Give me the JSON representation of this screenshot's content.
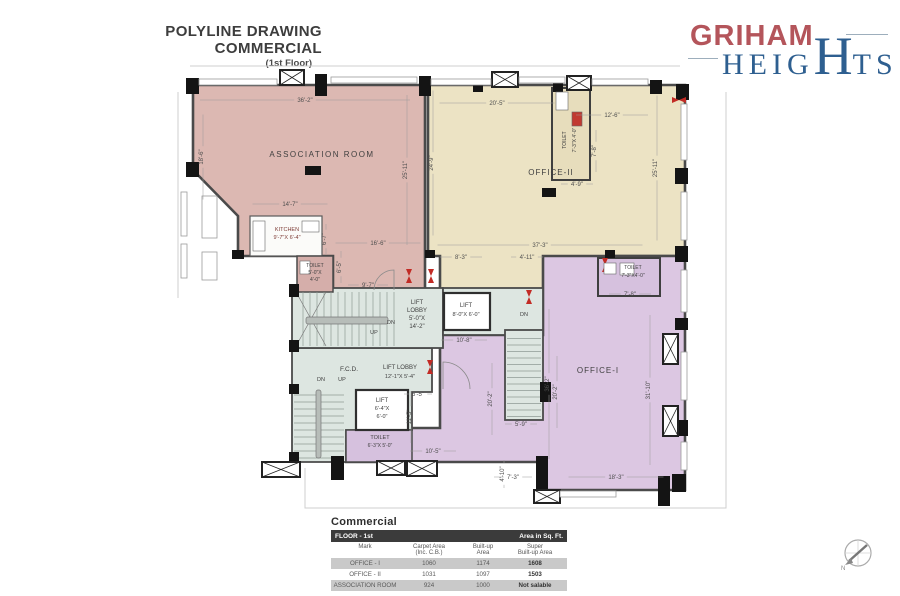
{
  "title": {
    "line1": "POLYLINE DRAWING",
    "line2": "COMMERCIAL",
    "line3": "(1st Floor)"
  },
  "logo": {
    "brand": "GRIHAM",
    "heights_pre": "HEIG",
    "heights_big": "H",
    "heights_post": "TS",
    "brand_color": "#b4555b",
    "heights_color": "#2e5f90"
  },
  "compass": {
    "label": "N",
    "cx": 858,
    "cy": 553,
    "r": 13
  },
  "table": {
    "title": "Commercial",
    "header_left": "FLOOR -  1st",
    "header_right": "Area in Sq. Ft.",
    "columns": [
      [
        "Mark"
      ],
      [
        "Carpet Area",
        "(Inc. C.B.)"
      ],
      [
        "Built-up",
        "Area"
      ],
      [
        "Super",
        "Built-up Area"
      ]
    ],
    "rows": [
      [
        "OFFICE - I",
        "1060",
        "1174",
        "1608"
      ],
      [
        "OFFICE - II",
        "1031",
        "1097",
        "1503"
      ],
      [
        "ASSOCIATION ROOM",
        "924",
        "1000",
        "Not salable"
      ]
    ]
  },
  "plan": {
    "colors": {
      "association": "#dcb8b2",
      "office2": "#ece3c4",
      "office1": "#dcc7e2",
      "hall": "#dde6e1",
      "wall": "#4a4a4a",
      "door": "#c22b25"
    },
    "site_lines": [
      "M 726,92 L 726,508 L 305,508 L 305,468",
      "M 190,66 L 680,66",
      "M 178,92 L 178,298"
    ],
    "regions": [
      {
        "n": "room-association",
        "pts": "193,85 425,85 425,292 333,292 333,256 238,256 238,216 193,170",
        "f": "#dcb8b2",
        "sw": 2.6
      },
      {
        "n": "room-office-2",
        "pts": "428,85 685,85 685,256 610,256 610,292 440,292 440,256 428,256",
        "f": "#ece3c4",
        "sw": 2.6
      },
      {
        "n": "room-office-1",
        "pts": "543,256 685,256 685,490 543,490 543,462 346,462 346,428 440,428 440,335 543,335",
        "f": "#dcc7e2",
        "sw": 2.6
      },
      {
        "n": "hall-lower",
        "pts": "292,348 432,348 432,392 412,392 412,430 346,430 346,462 292,462",
        "f": "#dde6e1",
        "sw": 1.8
      }
    ],
    "rects": [
      {
        "n": "hall-upper",
        "x": 292,
        "y": 288,
        "w": 151,
        "h": 60,
        "f": "#dde6e1",
        "s": "#4a4a4a",
        "sw": 1.8
      },
      {
        "n": "hall-lift-landing",
        "x": 443,
        "y": 288,
        "w": 100,
        "h": 47,
        "f": "#dde6e1",
        "s": "#4a4a4a",
        "sw": 1.8
      },
      {
        "n": "stair-well-right",
        "x": 505,
        "y": 330,
        "w": 38,
        "h": 90,
        "f": "#dde6e1",
        "s": "#4a4a4a",
        "sw": 1.8
      },
      {
        "n": "kitchen-room",
        "x": 250,
        "y": 216,
        "w": 72,
        "h": 40,
        "f": "#fbfbf9",
        "s": "#5a5a5a",
        "sw": 1.2
      },
      {
        "n": "toilet-association",
        "x": 297,
        "y": 256,
        "w": 36,
        "h": 36,
        "f": "#d5aeaa",
        "s": "#4a4a4a",
        "sw": 1.5
      },
      {
        "n": "toilet-office-2",
        "x": 552,
        "y": 88,
        "w": 38,
        "h": 92,
        "f": "#e7ddbc",
        "s": "#3f3f3f",
        "sw": 2
      },
      {
        "n": "toilet-office-1",
        "x": 598,
        "y": 258,
        "w": 62,
        "h": 38,
        "f": "#d6c1de",
        "s": "#3f3f3f",
        "sw": 2
      },
      {
        "n": "toilet-hall",
        "x": 346,
        "y": 430,
        "w": 66,
        "h": 32,
        "f": "#d6c1de",
        "s": "#4a4a4a",
        "sw": 1.5
      },
      {
        "n": "lift-1",
        "x": 444,
        "y": 293,
        "w": 46,
        "h": 37,
        "f": "#ffffff",
        "s": "#2f2f2f",
        "sw": 2.2
      },
      {
        "n": "lift-2",
        "x": 356,
        "y": 390,
        "w": 52,
        "h": 40,
        "f": "#ffffff",
        "s": "#2f2f2f",
        "sw": 2.2
      }
    ],
    "stairs": [
      {
        "x": 296,
        "y": 292,
        "w": 100,
        "h": 54,
        "o": "v",
        "step": 7,
        "rail": [
          306,
          317,
          82,
          7
        ],
        "cross": true
      },
      {
        "x": 294,
        "y": 388,
        "w": 50,
        "h": 72,
        "o": "h",
        "step": 7,
        "rail": [
          316,
          390,
          5,
          68
        ]
      },
      {
        "x": 507,
        "y": 332,
        "w": 34,
        "h": 86,
        "o": "h",
        "step": 6.5
      }
    ],
    "cols": [
      [
        186,
        78,
        13,
        16
      ],
      [
        315,
        74,
        12,
        22
      ],
      [
        419,
        76,
        12,
        20
      ],
      [
        473,
        80,
        10,
        12
      ],
      [
        553,
        80,
        10,
        12
      ],
      [
        650,
        80,
        12,
        14
      ],
      [
        676,
        84,
        13,
        16
      ],
      [
        186,
        162,
        13,
        15
      ],
      [
        232,
        250,
        12,
        9
      ],
      [
        289,
        284,
        10,
        13
      ],
      [
        289,
        340,
        10,
        12
      ],
      [
        289,
        384,
        10,
        10
      ],
      [
        289,
        452,
        10,
        10
      ],
      [
        675,
        168,
        13,
        16
      ],
      [
        675,
        246,
        13,
        16
      ],
      [
        675,
        318,
        13,
        12
      ],
      [
        675,
        420,
        13,
        16
      ],
      [
        672,
        474,
        14,
        18
      ],
      [
        305,
        166,
        16,
        9
      ],
      [
        542,
        188,
        14,
        9
      ],
      [
        540,
        382,
        11,
        20
      ],
      [
        331,
        456,
        13,
        24
      ],
      [
        536,
        456,
        12,
        36
      ],
      [
        658,
        476,
        12,
        30
      ],
      [
        425,
        250,
        10,
        8
      ],
      [
        605,
        250,
        10,
        8
      ]
    ],
    "xboxes": [
      [
        280,
        70,
        24,
        15
      ],
      [
        492,
        72,
        26,
        15
      ],
      [
        567,
        76,
        24,
        14
      ],
      [
        663,
        334,
        15,
        30
      ],
      [
        663,
        406,
        15,
        30
      ],
      [
        262,
        462,
        38,
        15
      ],
      [
        377,
        461,
        28,
        14
      ],
      [
        407,
        461,
        30,
        15
      ],
      [
        534,
        490,
        26,
        13
      ]
    ],
    "wins": [
      [
        199,
        79,
        78,
        6
      ],
      [
        331,
        77,
        86,
        6
      ],
      [
        431,
        79,
        60,
        6
      ],
      [
        519,
        77,
        46,
        6
      ],
      [
        592,
        79,
        56,
        6
      ],
      [
        181,
        192,
        6,
        44
      ],
      [
        181,
        244,
        6,
        34
      ],
      [
        202,
        196,
        15,
        42
      ],
      [
        202,
        252,
        15,
        28
      ],
      [
        681,
        104,
        6,
        56
      ],
      [
        681,
        192,
        6,
        48
      ],
      [
        681,
        270,
        6,
        42
      ],
      [
        681,
        352,
        6,
        48
      ],
      [
        681,
        442,
        6,
        28
      ],
      [
        560,
        491,
        56,
        6
      ]
    ],
    "arcs": [
      "M 443,389 L 443,362 A 27 27 0 0 1 470,389",
      "M 394,290 L 394,270 A 20 20 0 0 0 374,290"
    ],
    "doors": [
      [
        409,
        276,
        "v"
      ],
      [
        431,
        276,
        "v"
      ],
      [
        529,
        297,
        "v"
      ],
      [
        430,
        367,
        "v"
      ],
      [
        605,
        265,
        "v"
      ],
      [
        679,
        100,
        "h"
      ]
    ],
    "fixtures": [
      [
        572,
        112,
        10,
        14,
        "#c13a31"
      ],
      [
        556,
        92,
        12,
        18,
        "#ffffff"
      ],
      [
        604,
        263,
        12,
        11,
        "#ffffff"
      ],
      [
        620,
        263,
        14,
        12,
        "#ffffff"
      ],
      [
        300,
        261,
        10,
        13,
        "#ffffff"
      ],
      [
        253,
        221,
        12,
        30,
        "#ffffff"
      ],
      [
        302,
        221,
        17,
        11,
        "#ffffff"
      ]
    ],
    "dims": [
      {
        "t": "36'-2\"",
        "x": 305,
        "y": 102,
        "r": 0,
        "len": 210
      },
      {
        "t": "18'-6\"",
        "x": 203,
        "y": 157,
        "r": 90,
        "len": 85
      },
      {
        "t": "25'-11\"",
        "x": 407,
        "y": 170,
        "r": 90,
        "len": 150
      },
      {
        "t": "14'-7\"",
        "x": 290,
        "y": 206,
        "r": 0,
        "len": 75
      },
      {
        "t": "16'-6\"",
        "x": 378,
        "y": 245,
        "r": 0,
        "len": 85
      },
      {
        "t": "9'-7\"",
        "x": 368,
        "y": 287,
        "r": 0,
        "len": 40
      },
      {
        "t": "6'-5\"",
        "x": 341,
        "y": 267,
        "r": 90,
        "len": 32
      },
      {
        "t": "6'-7\"",
        "x": 326,
        "y": 239,
        "r": 90,
        "len": 30
      },
      {
        "t": "20'-5\"",
        "x": 497,
        "y": 105,
        "r": 0,
        "len": 115
      },
      {
        "t": "12'-6\"",
        "x": 612,
        "y": 117,
        "r": 0,
        "len": 72
      },
      {
        "t": "7'-8\"",
        "x": 596,
        "y": 151,
        "r": 90,
        "len": 42
      },
      {
        "t": "4'-9\"",
        "x": 577,
        "y": 186,
        "r": 0,
        "len": 32
      },
      {
        "t": "24'-9\"",
        "x": 433,
        "y": 163,
        "r": 90,
        "len": 145
      },
      {
        "t": "25'-11\"",
        "x": 657,
        "y": 168,
        "r": 90,
        "len": 145
      },
      {
        "t": "37'-3\"",
        "x": 540,
        "y": 247,
        "r": 0,
        "len": 205
      },
      {
        "t": "8'-3\"",
        "x": 461,
        "y": 259,
        "r": 0,
        "len": 42
      },
      {
        "t": "4'-11\"",
        "x": 527,
        "y": 259,
        "r": 0,
        "len": 32
      },
      {
        "t": "7'-8\"",
        "x": 630,
        "y": 296,
        "r": 0,
        "len": 42
      },
      {
        "t": "10'-8\"",
        "x": 464,
        "y": 342,
        "r": 0,
        "len": 46
      },
      {
        "t": "5'-5\"",
        "x": 418,
        "y": 396,
        "r": 0,
        "len": 28
      },
      {
        "t": "11'-5\"",
        "x": 411,
        "y": 417,
        "r": 90,
        "len": 52
      },
      {
        "t": "10'-5\"",
        "x": 433,
        "y": 453,
        "r": 0,
        "len": 46
      },
      {
        "t": "5'-9\"",
        "x": 521,
        "y": 426,
        "r": 0,
        "len": 32
      },
      {
        "t": "20'-2\"",
        "x": 492,
        "y": 399,
        "r": 90,
        "len": 72
      },
      {
        "t": "20'-2\"",
        "x": 557,
        "y": 392,
        "r": 90,
        "len": 72
      },
      {
        "t": "36'-2\"",
        "x": 549,
        "y": 384,
        "r": 90,
        "len": 150
      },
      {
        "t": "31'-10\"",
        "x": 650,
        "y": 390,
        "r": 90,
        "len": 150
      },
      {
        "t": "4'-10\"",
        "x": 504,
        "y": 474,
        "r": 90,
        "len": 28
      },
      {
        "t": "7'-3\"",
        "x": 513,
        "y": 479,
        "r": 0,
        "len": 38
      },
      {
        "t": "18'-3\"",
        "x": 616,
        "y": 479,
        "r": 0,
        "len": 95
      }
    ],
    "labels": [
      {
        "n": "room-label-association",
        "t": "ASSOCIATION ROOM",
        "x": 322,
        "y": 157,
        "s": 8,
        "ls": 1.5
      },
      {
        "n": "room-label-office-2",
        "t": "OFFICE-II",
        "x": 551,
        "y": 175,
        "s": 8,
        "ls": 1
      },
      {
        "n": "room-label-office-1",
        "t": "OFFICE-I",
        "x": 598,
        "y": 373,
        "s": 8,
        "ls": 1
      },
      {
        "n": "kitchen-label",
        "t": "KITCHEN",
        "x": 287,
        "y": 231,
        "s": 5.5,
        "c": "#7d3b35"
      },
      {
        "n": "kitchen-size-label",
        "t": "9'-7\"X 6'-4\"",
        "x": 287,
        "y": 239,
        "s": 5.5,
        "c": "#7d3b35"
      },
      {
        "n": "toilet-label",
        "t": "TOILET",
        "x": 315,
        "y": 267,
        "s": 5
      },
      {
        "n": "toilet-size-label",
        "t": "5'-0\"X",
        "x": 315,
        "y": 274,
        "s": 5
      },
      {
        "n": "toilet-size-label",
        "t": "4'-0\"",
        "x": 315,
        "y": 281,
        "s": 5
      },
      {
        "n": "toilet-label",
        "t": "TOILET",
        "x": 566,
        "y": 140,
        "s": 5,
        "r": -90
      },
      {
        "n": "toilet-size-label",
        "t": "7'-3\"X 4'-0\"",
        "x": 576,
        "y": 140,
        "s": 5,
        "r": -90
      },
      {
        "n": "toilet-label",
        "t": "TOILET",
        "x": 633,
        "y": 269,
        "s": 5
      },
      {
        "n": "toilet-size-label",
        "t": "7'-3\"X4'-0\"",
        "x": 633,
        "y": 277,
        "s": 5
      },
      {
        "n": "toilet-label",
        "t": "TOILET",
        "x": 380,
        "y": 439,
        "s": 5.5
      },
      {
        "n": "toilet-size-label",
        "t": "6'-3\"X 5'-0\"",
        "x": 380,
        "y": 447,
        "s": 5
      },
      {
        "n": "lift-lobby-label",
        "t": "LIFT",
        "x": 417,
        "y": 304,
        "s": 6
      },
      {
        "n": "lift-lobby-label",
        "t": "LOBBY",
        "x": 417,
        "y": 312,
        "s": 6
      },
      {
        "n": "lift-lobby-label",
        "t": "5'-0\"X",
        "x": 417,
        "y": 320,
        "s": 6
      },
      {
        "n": "lift-lobby-label",
        "t": "14'-2\"",
        "x": 417,
        "y": 328,
        "s": 6
      },
      {
        "n": "lift-label",
        "t": "LIFT",
        "x": 466,
        "y": 307,
        "s": 6
      },
      {
        "n": "lift-size-label",
        "t": "8'-0\"X 6'-0\"",
        "x": 466,
        "y": 316,
        "s": 5.5
      },
      {
        "n": "lift-lobby-label",
        "t": "LIFT LOBBY",
        "x": 400,
        "y": 369,
        "s": 6
      },
      {
        "n": "lift-lobby-size-label",
        "t": "12'-1\"X 5'-4\"",
        "x": 400,
        "y": 378,
        "s": 5.5
      },
      {
        "n": "lift-label",
        "t": "LIFT",
        "x": 382,
        "y": 402,
        "s": 6
      },
      {
        "n": "lift-size-label",
        "t": "6'-4\"X",
        "x": 382,
        "y": 410,
        "s": 5.5
      },
      {
        "n": "lift-size-label",
        "t": "6'-0\"",
        "x": 382,
        "y": 418,
        "s": 5.5
      },
      {
        "n": "fcd-label",
        "t": "F.C.D.",
        "x": 349,
        "y": 371,
        "s": 6.5
      },
      {
        "n": "stair-dn-label",
        "t": "DN",
        "x": 391,
        "y": 324,
        "s": 5.5
      },
      {
        "n": "stair-up-label",
        "t": "UP",
        "x": 374,
        "y": 334,
        "s": 5.5
      },
      {
        "n": "stair-dn-label",
        "t": "DN",
        "x": 321,
        "y": 381,
        "s": 5.5
      },
      {
        "n": "stair-up-label",
        "t": "UP",
        "x": 342,
        "y": 381,
        "s": 5.5
      },
      {
        "n": "stair-dn-label",
        "t": "DN",
        "x": 524,
        "y": 316,
        "s": 5.5
      }
    ]
  }
}
